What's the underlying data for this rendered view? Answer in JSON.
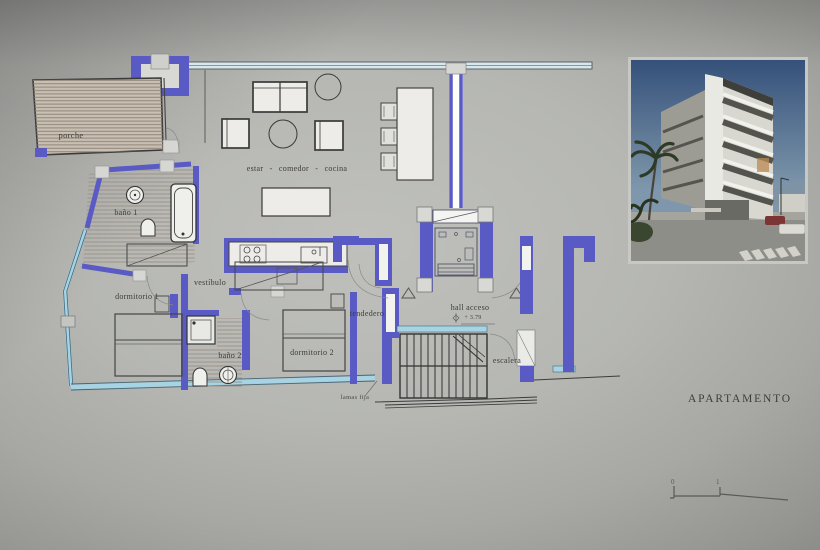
{
  "title": "APARTAMENTO",
  "plan": {
    "rooms": {
      "porche": "porche",
      "estar_comedor_cocina": "estar  -  comedor  -  cocina",
      "bano1": "baño 1",
      "dormitorio1": "dormitorio 1",
      "vestibulo": "vestíbulo",
      "tendedero": "tendedero",
      "dormitorio2": "dormitorio 2",
      "bano2": "baño 2",
      "hall_acceso": "hall acceso",
      "escalera": "escalera"
    },
    "annotations": {
      "level_mark": "+ 3.79",
      "lamas_fija": "lamas fija"
    }
  },
  "scale_bar": {
    "tick_0": "0",
    "tick_1": "1"
  },
  "colors": {
    "wall_blue": "#5a5ac4",
    "glazing_blue": "#a6d4e4",
    "hatch_tan": "#93887b",
    "line_dark": "#3c3c3c",
    "paper_gray": "#b3b4b0",
    "sky_blue": "#3c5b80"
  }
}
